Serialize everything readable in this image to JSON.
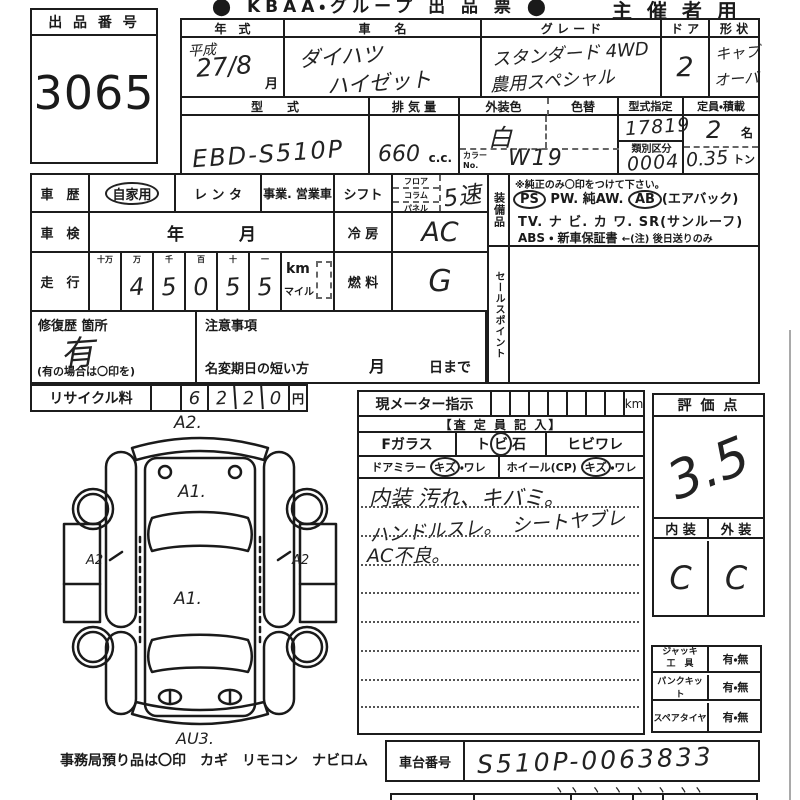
{
  "header": {
    "logo_text": "⬤ KBAA・グループ 出 品 票 ⬤",
    "organizer": "主 催 者 用"
  },
  "exhibit": {
    "label": "出 品 番 号",
    "number": "3065"
  },
  "vehicle": {
    "year_label": "年　式",
    "year_era": "平成",
    "year_num": "27/8",
    "year_unit": "月",
    "name_label": "車　　名",
    "name_line1": "ダイハツ",
    "name_line2": "ハイゼット",
    "grade_label": "グ レ ー ド",
    "grade_line1": "スタンダード 4WD",
    "grade_line2": "農用スペシャル",
    "door_label": "ド ア",
    "door_value": "2",
    "shape_label": "形 状",
    "shape_line1": "キャブ",
    "shape_line2": "オーバ",
    "model_label": "型　　式",
    "model_value": "EBD-S510P",
    "disp_label": "排 気 量",
    "disp_value": "660",
    "disp_unit": "c.c.",
    "color_label": "外装色",
    "color_value": "白",
    "color_change_label": "色替",
    "color_no_label1": "カラー",
    "color_no_label2": "No.",
    "color_no_value": "W19",
    "type_label": "型式指定",
    "type_value": "17819",
    "class_label": "類別区分",
    "class_value": "0004",
    "cap_label": "定員・積載",
    "cap_value": "2",
    "cap_unit": "名",
    "load_value": "0.35",
    "load_unit": "トン"
  },
  "history": {
    "label": "車　歴",
    "opt1": "自家用",
    "opt2": "レ ン タ",
    "opt3": "事業. 営業車"
  },
  "shaken": {
    "label": "車　検",
    "year": "年",
    "month": "月"
  },
  "mileage": {
    "label": "走　行",
    "headers": [
      "十万",
      "万",
      "千",
      "百",
      "十",
      "一"
    ],
    "digits": [
      "",
      "4",
      "5",
      "0",
      "5",
      "5"
    ],
    "unit1": "km",
    "unit2": "マイル"
  },
  "shift": {
    "label": "シフト",
    "opt1": "フロア",
    "opt2": "コラム",
    "opt3": "パネル",
    "value": "5速"
  },
  "cooling": {
    "label": "冷 房",
    "value": "AC"
  },
  "fuel": {
    "label": "燃 料",
    "value": "G"
  },
  "equipment": {
    "label": "装備品",
    "note": "※純正のみ〇印をつけて下さい。",
    "ps": "PS",
    "pw": "PW.",
    "aw": "純AW.",
    "ab": "AB",
    "ab_note": "(エアバック)",
    "tv": "TV.",
    "navi": "ナ ビ.",
    "kawa": "カ ワ.",
    "sr": "SR",
    "sr_note": "(サンルーフ)",
    "abs": "ABS",
    "sep": "・",
    "warranty": "新車保証書",
    "warranty_note": "←(注) 後日送りのみ"
  },
  "sales": {
    "label": "セールスポイント"
  },
  "repair": {
    "label": "修復歴 箇所",
    "value": "有",
    "note": "(有の場合は〇印を)"
  },
  "caution": {
    "label": "注意事項",
    "rename_label": "名変期日の短い方",
    "month": "月",
    "day": "日まで"
  },
  "recycle": {
    "label": "リサイクル料",
    "d1": "6",
    "d2": "2",
    "d3": "2",
    "d4": "0",
    "unit": "円"
  },
  "diagram": {
    "mark_top": "A2.",
    "mark_hood": "A1.",
    "mark_left": "A2",
    "mark_right": "A2",
    "mark_center": "A1.",
    "mark_bottom": "AU3."
  },
  "meter": {
    "label": "現メーター指示",
    "unit": "km",
    "assessor": "【査 定 員 記 入】",
    "fglass": "Fガラス",
    "tobi_a": "ト",
    "tobi_b": "ビ",
    "tobi_c": "石",
    "hibi": "ヒビワレ",
    "mirror_label": "ドアミラー",
    "mirror_kizu": "キズ",
    "mirror_ware": "・ワレ",
    "wheel_label": "ホイール(CP)",
    "wheel_kizu": "キズ",
    "wheel_ware": "・ワレ",
    "comment1": "内装 汚れ、キバミ。",
    "comment2": "ハンドルスレ。　シートヤブレ",
    "comment3": "AC不良。"
  },
  "score": {
    "label": "評 価 点",
    "value": "3.5"
  },
  "grade_io": {
    "interior_label": "内 装",
    "exterior_label": "外 装",
    "interior": "C",
    "exterior": "C"
  },
  "tools": {
    "jack_label1": "ジャッキ",
    "jack_label2": "工　具",
    "jack_value": "有・無",
    "punk_label": "パンクキット",
    "punk_value": "有・無",
    "spare_label": "スペアタイヤ",
    "spare_value": "有・無"
  },
  "chassis": {
    "label": "車台番号",
    "value": "S510P-0063833",
    "ticks": "ヽヽ ヽ ヽ ヽ ヽ ヽヽ"
  },
  "footer": {
    "note": "事務局預り品は〇印　カギ　リモコン　ナビロム"
  }
}
